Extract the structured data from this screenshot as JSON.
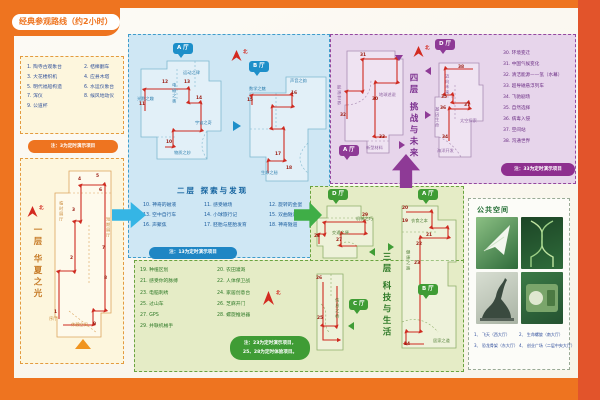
{
  "header": {
    "title": "经典参观路线（约2小时）"
  },
  "compass": "北",
  "colors": {
    "frame_orange": "#ee7420",
    "frame_right_red": "#e2542b",
    "route_red": "#cf2a20",
    "floor2_blue": "#1d8fc9",
    "floor3_green": "#3f9c35",
    "floor4_purple": "#8e3a96"
  },
  "floor1": {
    "title": "一层 华夏之光",
    "note": "注：3为定时演示项目",
    "items": [
      {
        "n": "1.",
        "t": "陶寺古观象台"
      },
      {
        "n": "2.",
        "t": "桔槔翻车"
      },
      {
        "n": "3.",
        "t": "大花楼织机"
      },
      {
        "n": "4.",
        "t": "应县木塔"
      },
      {
        "n": "5.",
        "t": "明代福船构造"
      },
      {
        "n": "6.",
        "t": "水运仪象台"
      },
      {
        "n": "7.",
        "t": "浑仪"
      },
      {
        "n": "8.",
        "t": "候风地动仪"
      },
      {
        "n": "9.",
        "t": "公道杯"
      }
    ]
  },
  "floor2": {
    "title": "二层 探索与发现",
    "note": "注：13为定时演示项目",
    "halls": {
      "a": "A 厅",
      "b": "B 厅"
    },
    "items": [
      {
        "n": "10.",
        "t": "神奇的磁液"
      },
      {
        "n": "11.",
        "t": "感受磁场"
      },
      {
        "n": "12.",
        "t": "旋转的金蛋"
      },
      {
        "n": "13.",
        "t": "空中自行车"
      },
      {
        "n": "14.",
        "t": "小球旅行记"
      },
      {
        "n": "15.",
        "t": "双曲隧道"
      },
      {
        "n": "16.",
        "t": "声聚焦"
      },
      {
        "n": "17.",
        "t": "胚胎与胚胎发育"
      },
      {
        "n": "18.",
        "t": "神奇隧道"
      }
    ]
  },
  "floor3": {
    "title": "三层 科技与生活",
    "note1": "注：23为定时演示项目，",
    "note2": "25、28为定时体验项目。",
    "halls": {
      "a": "A 厅",
      "b": "B 厅",
      "c": "C 厅",
      "d": "D 厅"
    },
    "items": [
      {
        "n": "19.",
        "t": "种植区划"
      },
      {
        "n": "20.",
        "t": "农田灌溉"
      },
      {
        "n": "21.",
        "t": "感受你的脉搏"
      },
      {
        "n": "22.",
        "t": "人体保卫战"
      },
      {
        "n": "23.",
        "t": "电脑刺绣"
      },
      {
        "n": "24.",
        "t": "家居创意台"
      },
      {
        "n": "25.",
        "t": "过山车"
      },
      {
        "n": "26.",
        "t": "芝麻开门"
      },
      {
        "n": "27.",
        "t": "GPS"
      },
      {
        "n": "28.",
        "t": "螺旋推进器"
      },
      {
        "n": "29.",
        "t": "并联机械手"
      }
    ]
  },
  "floor4": {
    "title": "四层 挑战与未来",
    "note": "注：33为定时演示项目",
    "halls": {
      "a": "A 厅",
      "d": "D 厅"
    },
    "items": [
      {
        "n": "30.",
        "t": "环境变迁"
      },
      {
        "n": "31.",
        "t": "中国气候变化"
      },
      {
        "n": "32.",
        "t": "清洁能源——氢（水幕）"
      },
      {
        "n": "33.",
        "t": "超导磁悬浮列车"
      },
      {
        "n": "34.",
        "t": "飞驰剧场"
      },
      {
        "n": "35.",
        "t": "自然选择"
      },
      {
        "n": "36.",
        "t": "病毒入侵"
      },
      {
        "n": "37.",
        "t": "空间站"
      },
      {
        "n": "38.",
        "t": "沟通世界"
      }
    ]
  },
  "public_space": {
    "title": "公共空间",
    "captions": [
      {
        "n": "1、",
        "t": "飞天（西大厅）"
      },
      {
        "n": "2、",
        "t": "生命螺旋（南大厅）"
      },
      {
        "n": "3、",
        "t": "恐龙骨架（东大厅）"
      },
      {
        "n": "4、",
        "t": "创业广场（二层中央大厅）"
      }
    ]
  },
  "maps": {
    "f1": {
      "nums": [
        {
          "t": "1",
          "x": 5,
          "y": 146
        },
        {
          "t": "2",
          "x": 21,
          "y": 92
        },
        {
          "t": "3",
          "x": 23,
          "y": 44
        },
        {
          "t": "4",
          "x": 29,
          "y": 13
        },
        {
          "t": "5",
          "x": 47,
          "y": 10
        },
        {
          "t": "6",
          "x": 50,
          "y": 24
        },
        {
          "t": "7",
          "x": 53,
          "y": 82
        },
        {
          "t": "8",
          "x": 55,
          "y": 112
        },
        {
          "t": "9",
          "x": 44,
          "y": 158
        }
      ],
      "labels": [
        {
          "t": "序厅",
          "x": 0,
          "y": 152
        },
        {
          "t": "休憩空间",
          "x": 22,
          "y": 158
        },
        {
          "t": "临时展厅",
          "x": 10,
          "y": 36,
          "v": 1
        },
        {
          "t": "短期展厅",
          "x": 57,
          "y": 52,
          "v": 1
        }
      ]
    },
    "f2a": {
      "nums": [
        {
          "t": "10",
          "x": 29,
          "y": 82
        },
        {
          "t": "11",
          "x": 2,
          "y": 44
        },
        {
          "t": "12",
          "x": 25,
          "y": 22
        },
        {
          "t": "13",
          "x": 47,
          "y": 22
        },
        {
          "t": "14",
          "x": 59,
          "y": 38
        }
      ],
      "labels": [
        {
          "t": "光影之趣",
          "x": 0,
          "y": 38
        },
        {
          "t": "电磁之奥",
          "x": 35,
          "y": 24,
          "v": 1
        },
        {
          "t": "运动之律",
          "x": 46,
          "y": 12
        },
        {
          "t": "宇宙之奇",
          "x": 58,
          "y": 62
        },
        {
          "t": "物质之妙",
          "x": 37,
          "y": 92
        }
      ]
    },
    "f2b": {
      "nums": [
        {
          "t": "15",
          "x": 1,
          "y": 26
        },
        {
          "t": "16",
          "x": 45,
          "y": 19
        },
        {
          "t": "17",
          "x": 29,
          "y": 80
        },
        {
          "t": "18",
          "x": 40,
          "y": 94
        }
      ],
      "labels": [
        {
          "t": "数学之魅",
          "x": 3,
          "y": 14
        },
        {
          "t": "声音之韵",
          "x": 44,
          "y": 6
        },
        {
          "t": "生命之秘",
          "x": 15,
          "y": 98
        }
      ]
    },
    "f4a": {
      "nums": [
        {
          "t": "31",
          "x": 23,
          "y": 9
        },
        {
          "t": "30",
          "x": 35,
          "y": 53
        },
        {
          "t": "32",
          "x": 3,
          "y": 69
        },
        {
          "t": "33",
          "x": 42,
          "y": 91
        }
      ],
      "labels": [
        {
          "t": "能源世界",
          "x": 0,
          "y": 40,
          "v": 1
        },
        {
          "t": "地球述说",
          "x": 42,
          "y": 48
        },
        {
          "t": "新型材料",
          "x": 29,
          "y": 101
        }
      ]
    },
    "f4b": {
      "nums": [
        {
          "t": "38",
          "x": 27,
          "y": 9
        },
        {
          "t": "35",
          "x": 10,
          "y": 39
        },
        {
          "t": "36",
          "x": 9,
          "y": 50
        },
        {
          "t": "37",
          "x": 33,
          "y": 47
        },
        {
          "t": "34",
          "x": 11,
          "y": 79
        }
      ],
      "labels": [
        {
          "t": "迈向未来",
          "x": 14,
          "y": 17,
          "v": 1
        },
        {
          "t": "基因生命",
          "x": 4,
          "y": 50,
          "v": 1
        },
        {
          "t": "太空探索",
          "x": 29,
          "y": 62
        },
        {
          "t": "海洋开发",
          "x": 6,
          "y": 92
        }
      ]
    },
    "f3d": {
      "nums": [
        {
          "t": "29",
          "x": 49,
          "y": 12
        },
        {
          "t": "27",
          "x": 23,
          "y": 37
        },
        {
          "t": "28",
          "x": 1,
          "y": 33
        }
      ],
      "labels": [
        {
          "t": "交通之便",
          "x": 19,
          "y": 29
        },
        {
          "t": "机械之巧",
          "x": 43,
          "y": 15
        }
      ]
    },
    "f3a": {
      "nums": [
        {
          "t": "20",
          "x": 8,
          "y": 5
        },
        {
          "t": "19",
          "x": 8,
          "y": 18
        },
        {
          "t": "21",
          "x": 32,
          "y": 32
        },
        {
          "t": "22",
          "x": 22,
          "y": 41
        },
        {
          "t": "23",
          "x": 20,
          "y": 60
        },
        {
          "t": "24",
          "x": 10,
          "y": 141
        }
      ],
      "labels": [
        {
          "t": "衣食之本",
          "x": 17,
          "y": 17
        },
        {
          "t": "健康之路",
          "x": 12,
          "y": 48,
          "v": 1
        },
        {
          "t": "居家之道",
          "x": 39,
          "y": 137
        }
      ]
    },
    "f3c": {
      "nums": [
        {
          "t": "26",
          "x": 3,
          "y": 9
        },
        {
          "t": "25",
          "x": 4,
          "y": 49
        }
      ],
      "labels": [
        {
          "t": "信息之桥",
          "x": 22,
          "y": 30,
          "v": 1
        }
      ]
    }
  }
}
